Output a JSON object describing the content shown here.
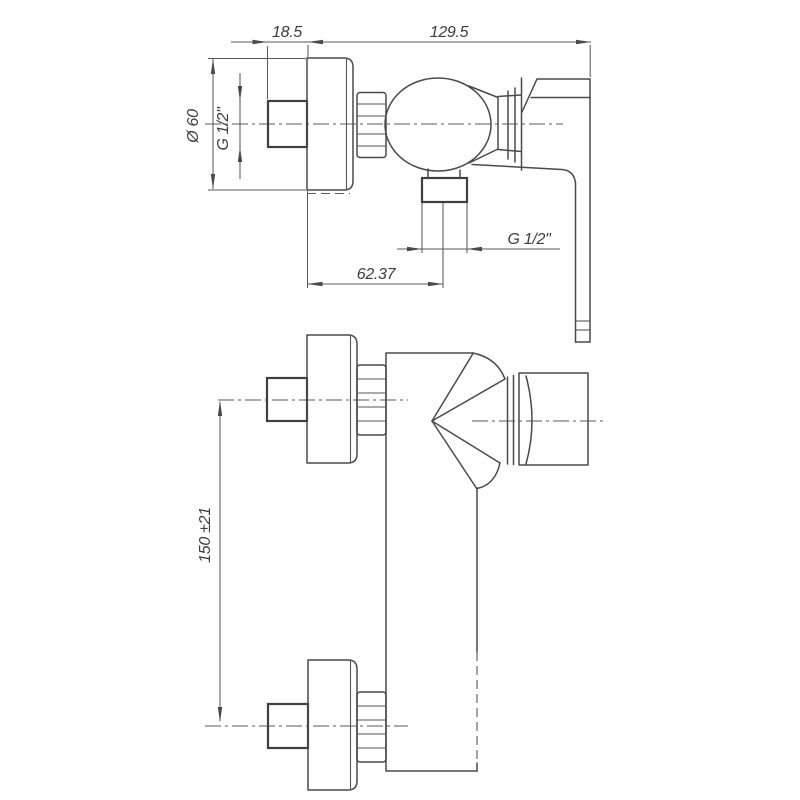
{
  "canvas": {
    "background": "#ffffff",
    "line_color": "#4a4a4a",
    "dimension_line_color": "#5a5a5a",
    "text_color": "#3c3c3c"
  },
  "drawing": {
    "type": "technical-drawing",
    "subject": "wall-mounted single-lever shower mixer, side view (top) and front view (bottom)"
  },
  "dimensions": {
    "wall_to_flange": "18.5",
    "flange_to_handle_end": "129.5",
    "flange_diameter": "Ø 60",
    "inlet_thread": "G 1/2\"",
    "outlet_thread": "G 1/2\"",
    "flange_to_outlet_center": "62.37",
    "inlet_center_spacing": "150 ±21"
  }
}
